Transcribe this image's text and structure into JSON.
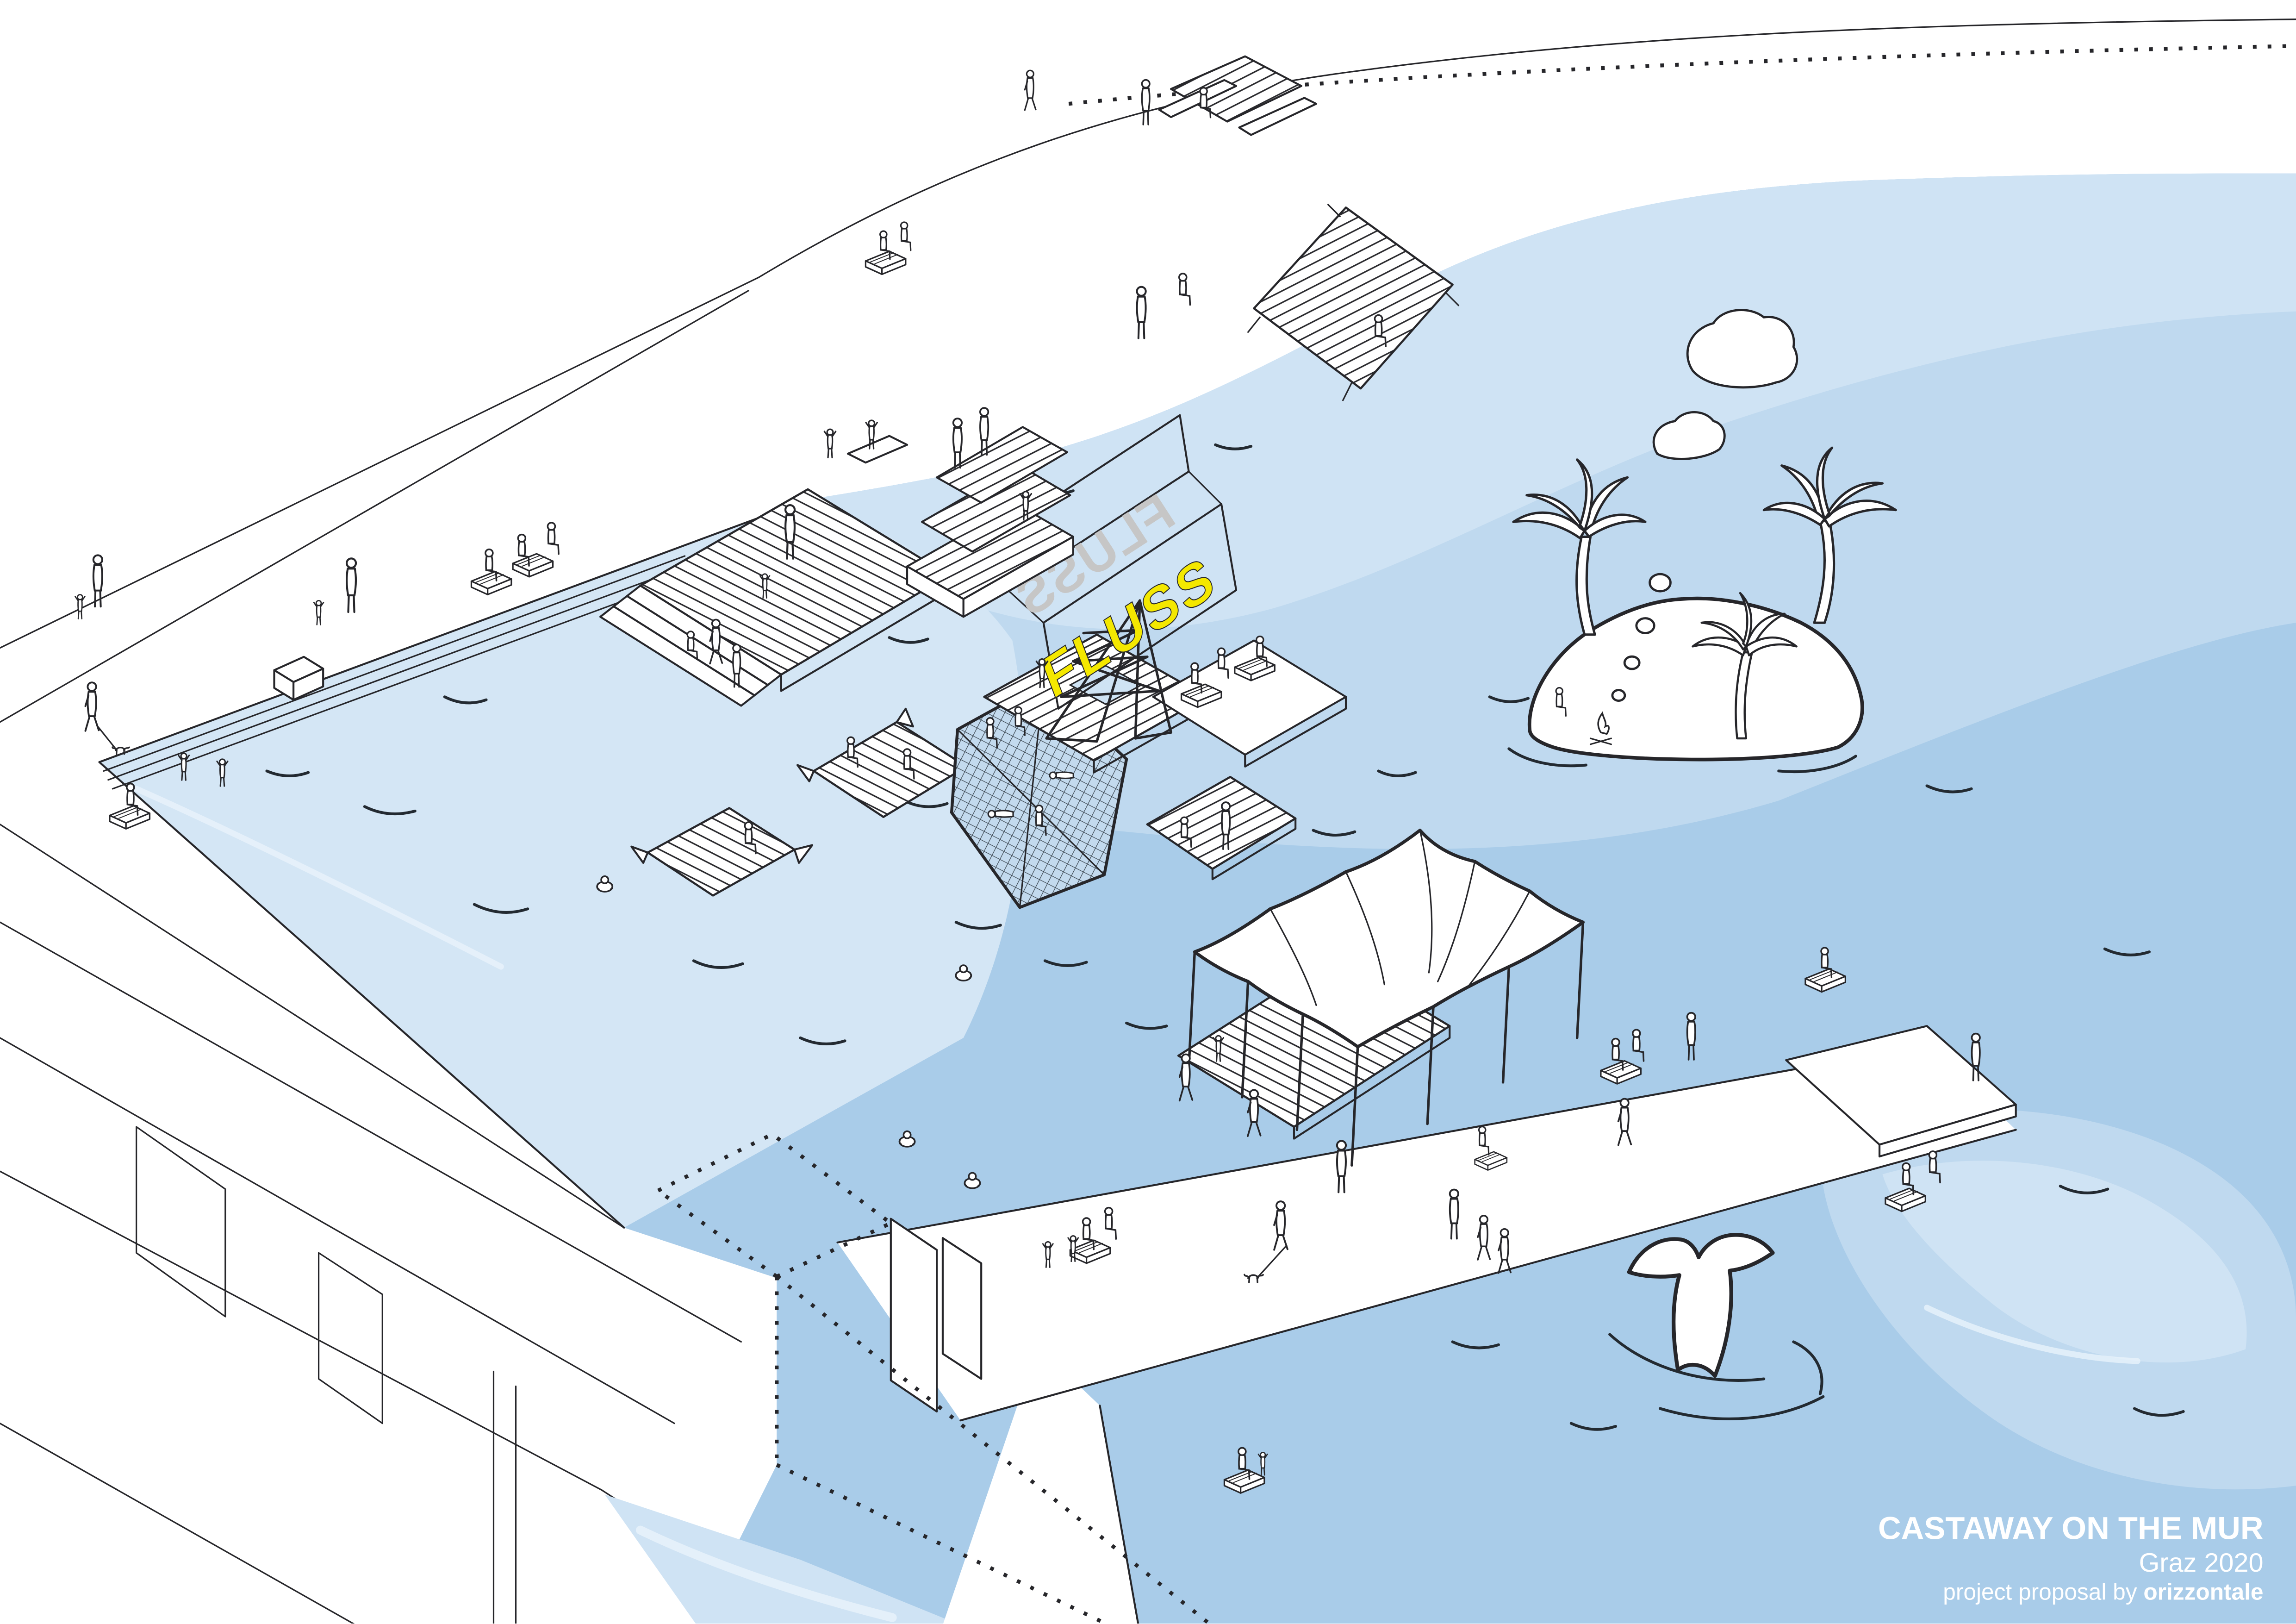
{
  "title_block": {
    "title": "CASTAWAY ON THE MUR",
    "subtitle": "Graz 2020",
    "credit_prefix": "project proposal by ",
    "credit_brand": "orizzontale",
    "text_color": "#ffffff"
  },
  "sign": {
    "front_text": "FLUSS",
    "back_text": "FLUSS",
    "front_color": "#f4e800",
    "back_color": "#c6c6c6"
  },
  "colors": {
    "background": "#ffffff",
    "line": "#26262a",
    "water_main": "#a9cce9",
    "water_mid": "#bfd9ef",
    "water_light": "#cfe3f4",
    "water_pool": "#d4e6f5",
    "water_highlight": "#e9f2fb"
  },
  "scene_elements": [
    "river-mur",
    "riverside-road",
    "quay-steps",
    "swimming-pool-basin",
    "bridge",
    "construction-dotted-lines",
    "pier-promenade",
    "stepped-bathing-deck",
    "floating-raft",
    "net-lounge-platform",
    "fluss-sign-tower",
    "tent-canopy",
    "deck-with-benches",
    "picnic-deck",
    "grandstand-steps",
    "benches",
    "palm-island",
    "castaway-campfire",
    "smoke-clouds",
    "whale-tail",
    "swimmers",
    "stick-figures"
  ]
}
